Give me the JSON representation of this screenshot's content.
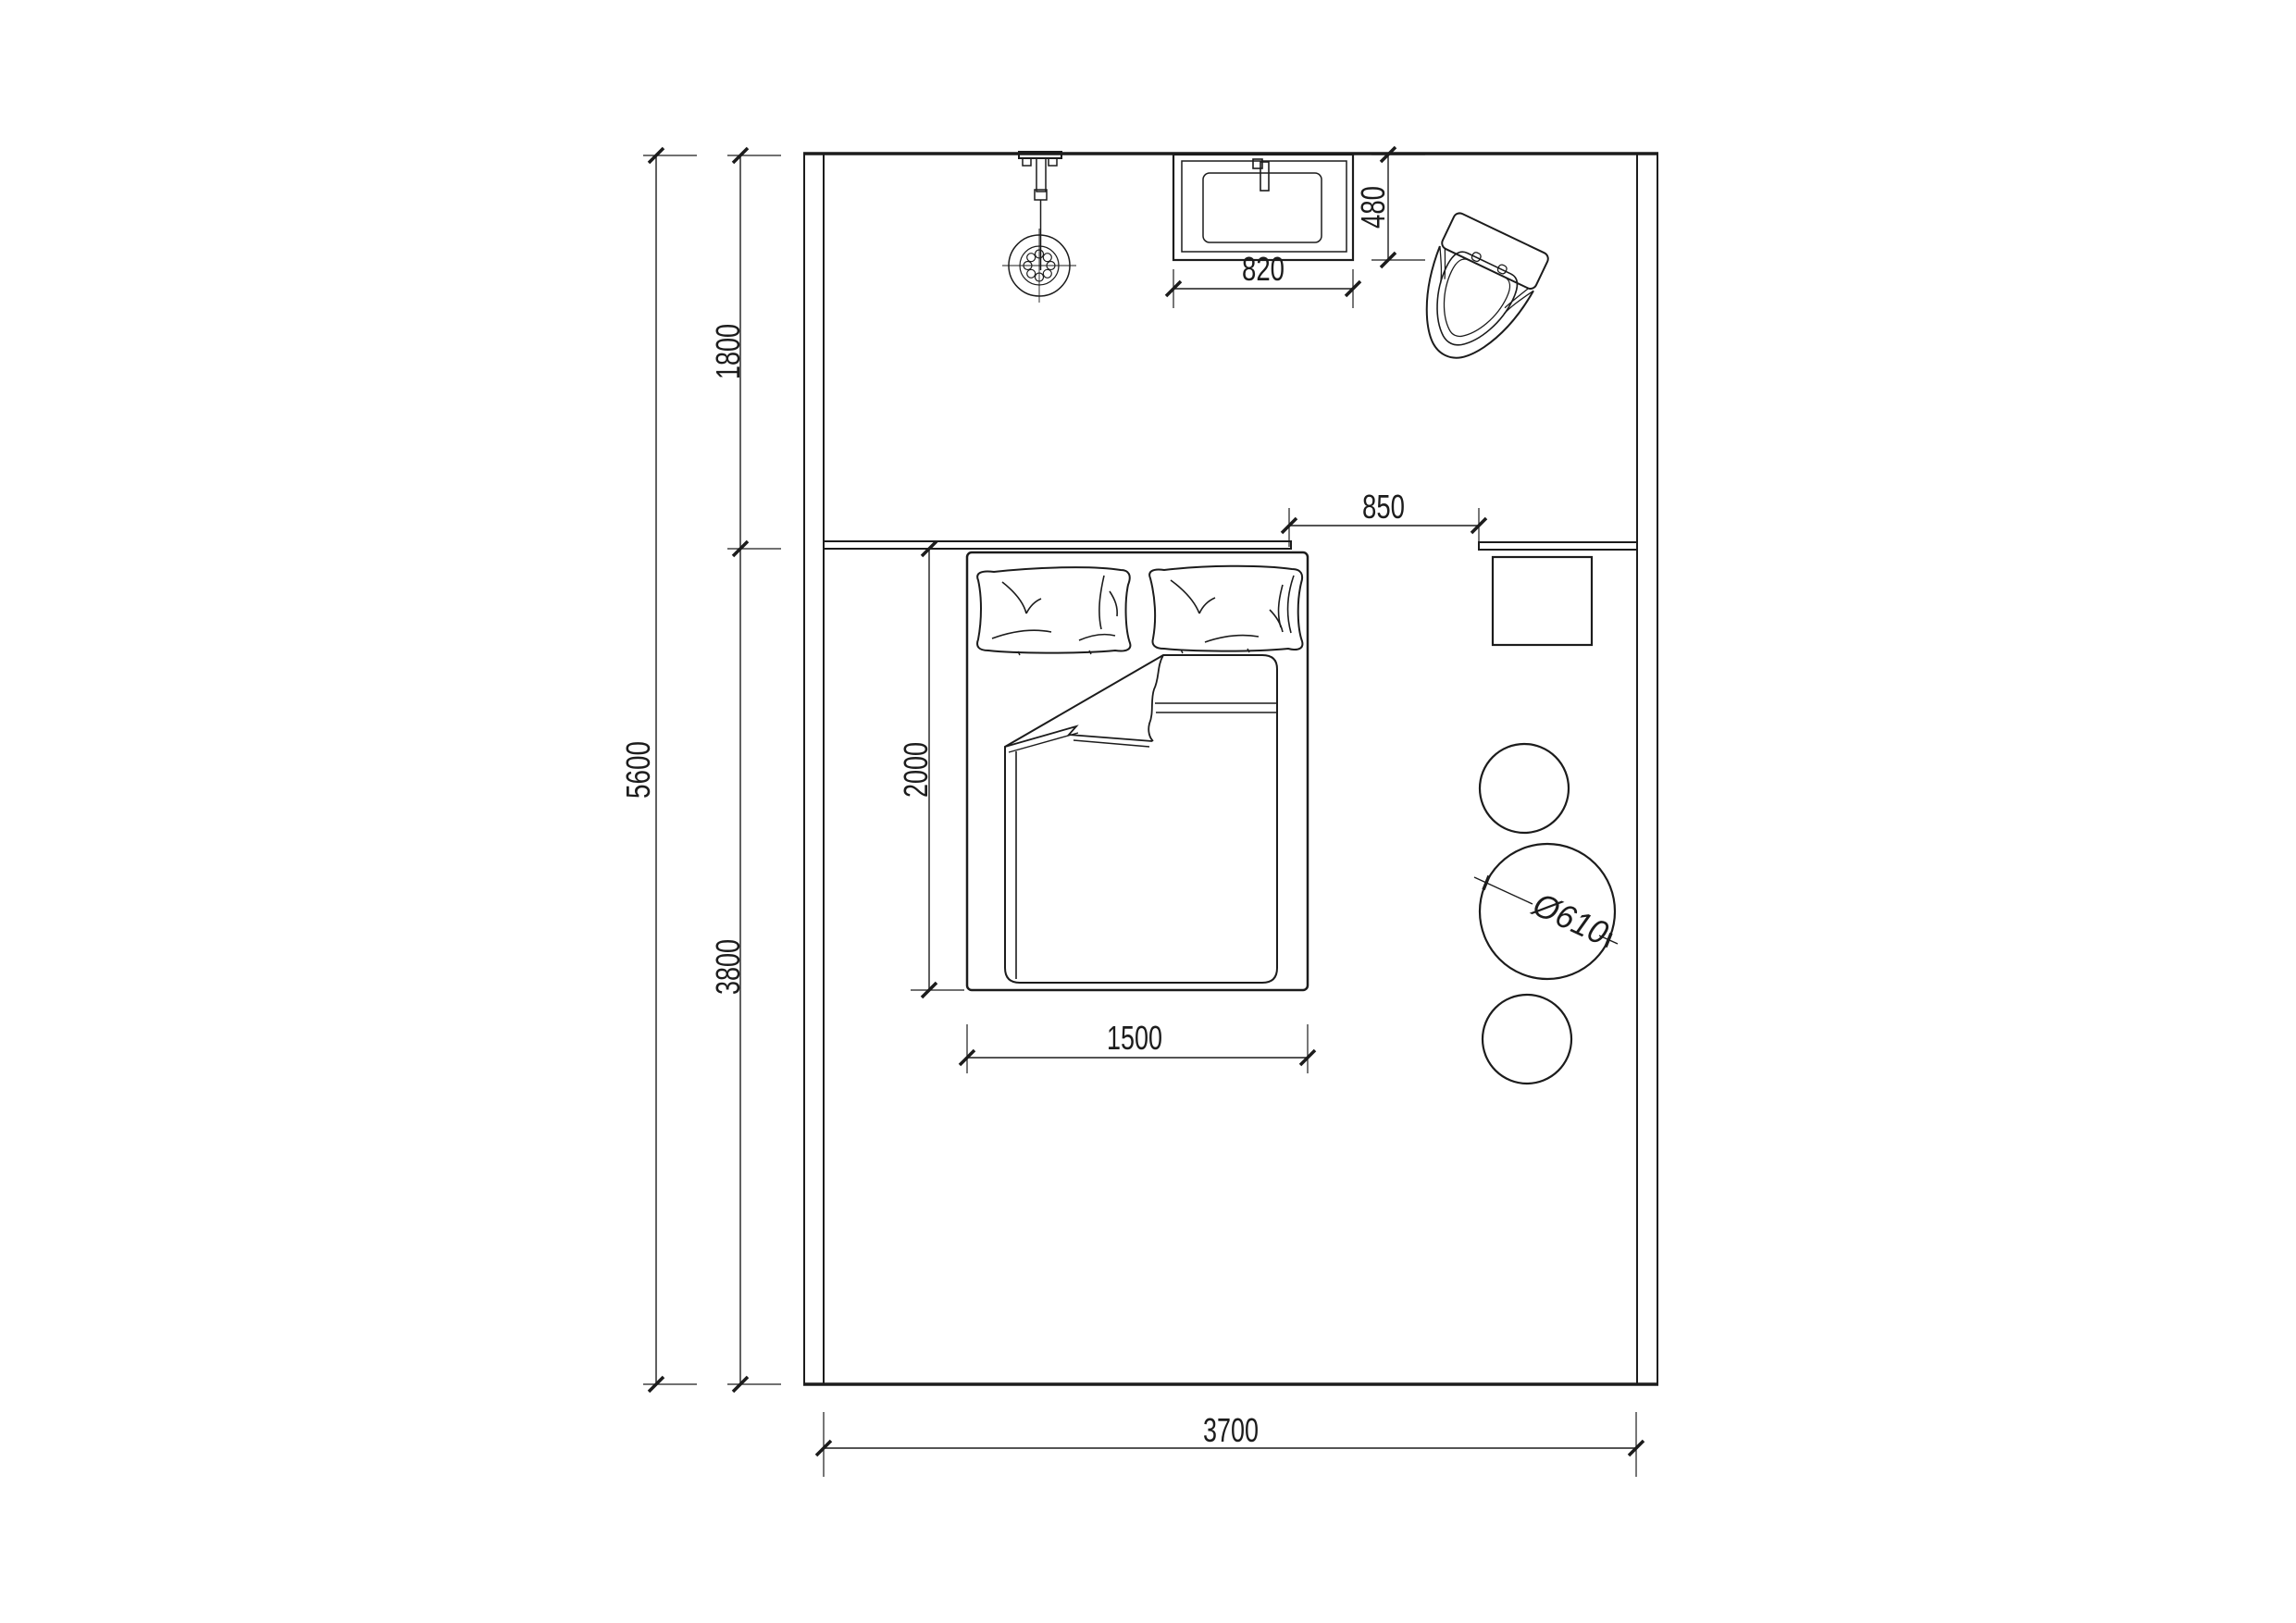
{
  "drawing": {
    "type": "bedroom floor plan",
    "background": "#ffffff",
    "line_color": "#1c1c1c",
    "dimensions": {
      "room_height_total": "5600",
      "zone_top_height": "1800",
      "zone_bottom_height": "3800",
      "room_width": "3700",
      "basin_width": "820",
      "basin_depth": "480",
      "passage_width": "850",
      "bed_length": "2000",
      "bed_width": "1500",
      "round_table_diameter": "Ø610"
    },
    "fixtures": [
      "shower-head",
      "wash-basin",
      "toilet",
      "double-bed",
      "pillows",
      "duvet",
      "headboard-counter",
      "side-table",
      "round-table",
      "stools"
    ]
  }
}
